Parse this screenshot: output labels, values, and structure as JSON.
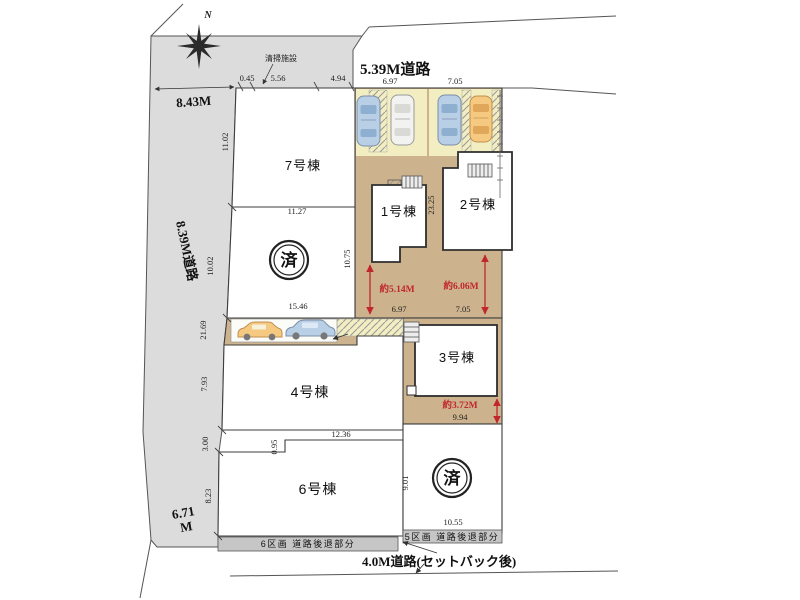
{
  "colors": {
    "lot_tan": "#cdb38d",
    "road_gray": "#dcdcdc",
    "pad_yellow": "#f2eec2",
    "dim_red": "#c0272d",
    "band_gray": "#c6c6c6",
    "car_blue": "#b9cfe6",
    "car_orange": "#f5c980",
    "car_white": "#f2f2f0"
  },
  "compass": {
    "north_label": "N"
  },
  "roads": {
    "top": "5.39M道路",
    "left_width": "8.43M",
    "left": "8.39M道路",
    "left_lower_line1": "6.71",
    "left_lower_line2": "M",
    "bottom": "4.0M道路(セットバック後)"
  },
  "facility": {
    "label": "清掃施設"
  },
  "buildings": {
    "b1": "1号棟",
    "b2": "2号棟",
    "b3": "3号棟",
    "b4": "4号棟",
    "b6": "6号棟",
    "b7": "7号棟"
  },
  "sold_stamp": "済",
  "setback_bands": {
    "left": "6区画 道路後退部分",
    "right": "5区画 道路後退部分"
  },
  "red_dims": {
    "lot1": "約5.14M",
    "lot2": "約6.06M",
    "lot3": "約3.72M"
  },
  "dims": {
    "top_045": "0.45",
    "top_556": "5.56",
    "top_494": "4.94",
    "lot1_top": "6.97",
    "lot2_top": "7.05",
    "lot1_bottom": "6.97",
    "lot2_bottom": "7.05",
    "lot3_width": "9.94",
    "lot5_width": "10.55",
    "v_1102": "11.02",
    "v_1002": "10.02",
    "v_2169": "21.69",
    "v_793": "7.93",
    "v_300": "3.00",
    "v_823": "8.23",
    "v_1075": "10.75",
    "v_2325": "23.25",
    "v_901": "9.01",
    "v_095": "0.95",
    "h_1127": "11.27",
    "h_1546": "15.46",
    "h_1236": "12.36"
  }
}
